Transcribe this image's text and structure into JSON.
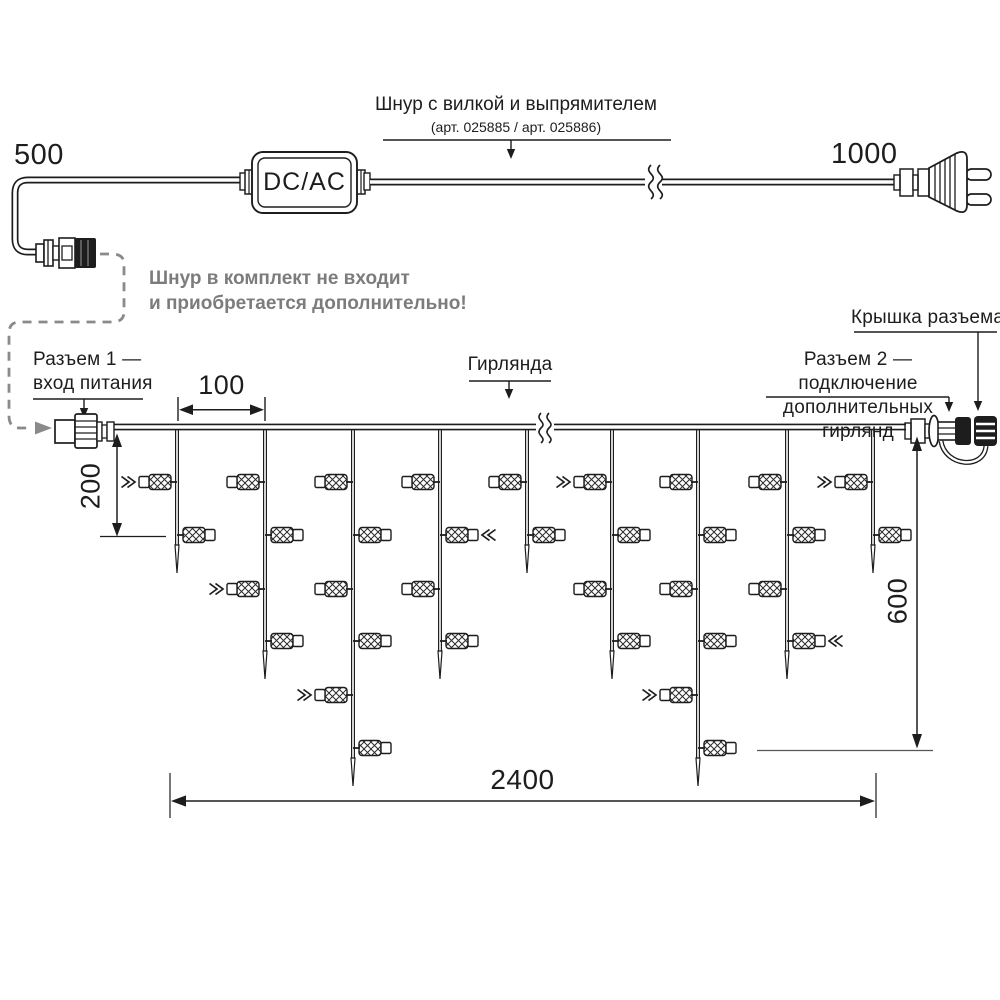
{
  "colors": {
    "line": "#1d1d1d",
    "note_gray": "#7c7c7c",
    "dash_gray": "#8a8a8a",
    "background": "#ffffff"
  },
  "power_cord": {
    "length_left_label": "500",
    "length_right_label": "1000",
    "converter_label": "DC/AC",
    "title": "Шнур с вилкой и выпрямителем",
    "subtitle": "(арт. 025885 / арт. 025886)",
    "note_line1": "Шнур в комплект не входит",
    "note_line2": "и приобретается дополнительно!"
  },
  "garland_labels": {
    "connector1_line1": "Разъем 1 —",
    "connector1_line2": "вход питания",
    "garland": "Гирлянда",
    "connector_cap": "Крышка разъема",
    "connector2_line1": "Разъем 2 — подключение",
    "connector2_line2": "дополнительных гирлянд"
  },
  "dimensions": {
    "drop_spacing": "100",
    "first_drop_depth": "200",
    "max_drop_depth": "600",
    "total_length": "2400"
  },
  "garland": {
    "wire_y": 427,
    "x_start": 114,
    "x_end": 906,
    "break_x": 545,
    "level_y": [
      482,
      535,
      589,
      641,
      695,
      748
    ],
    "drops": [
      {
        "x": 177,
        "bulbs": [
          {
            "level": 1,
            "side": "left",
            "arrow": true
          },
          {
            "level": 2,
            "side": "right",
            "arrow": false
          }
        ]
      },
      {
        "x": 265,
        "bulbs": [
          {
            "level": 1,
            "side": "left",
            "arrow": false
          },
          {
            "level": 2,
            "side": "right",
            "arrow": false
          },
          {
            "level": 3,
            "side": "left",
            "arrow": true
          },
          {
            "level": 4,
            "side": "right",
            "arrow": false
          }
        ]
      },
      {
        "x": 353,
        "bulbs": [
          {
            "level": 1,
            "side": "left",
            "arrow": false
          },
          {
            "level": 2,
            "side": "right",
            "arrow": false
          },
          {
            "level": 3,
            "side": "left",
            "arrow": false
          },
          {
            "level": 4,
            "side": "right",
            "arrow": false
          },
          {
            "level": 5,
            "side": "left",
            "arrow": true
          },
          {
            "level": 6,
            "side": "right",
            "arrow": false
          }
        ]
      },
      {
        "x": 440,
        "bulbs": [
          {
            "level": 1,
            "side": "left",
            "arrow": false
          },
          {
            "level": 2,
            "side": "right",
            "arrow": true
          },
          {
            "level": 3,
            "side": "left",
            "arrow": false
          },
          {
            "level": 4,
            "side": "right",
            "arrow": false
          }
        ]
      },
      {
        "x": 527,
        "bulbs": [
          {
            "level": 1,
            "side": "left",
            "arrow": false
          },
          {
            "level": 2,
            "side": "right",
            "arrow": false
          }
        ]
      },
      {
        "x": 612,
        "bulbs": [
          {
            "level": 1,
            "side": "left",
            "arrow": true
          },
          {
            "level": 2,
            "side": "right",
            "arrow": false
          },
          {
            "level": 3,
            "side": "left",
            "arrow": false
          },
          {
            "level": 4,
            "side": "right",
            "arrow": false
          }
        ]
      },
      {
        "x": 698,
        "bulbs": [
          {
            "level": 1,
            "side": "left",
            "arrow": false
          },
          {
            "level": 2,
            "side": "right",
            "arrow": false
          },
          {
            "level": 3,
            "side": "left",
            "arrow": false
          },
          {
            "level": 4,
            "side": "right",
            "arrow": false
          },
          {
            "level": 5,
            "side": "left",
            "arrow": true
          },
          {
            "level": 6,
            "side": "right",
            "arrow": false
          }
        ]
      },
      {
        "x": 787,
        "bulbs": [
          {
            "level": 1,
            "side": "left",
            "arrow": false
          },
          {
            "level": 2,
            "side": "right",
            "arrow": false
          },
          {
            "level": 3,
            "side": "left",
            "arrow": false
          },
          {
            "level": 4,
            "side": "right",
            "arrow": true
          }
        ]
      },
      {
        "x": 873,
        "bulbs": [
          {
            "level": 1,
            "side": "left",
            "arrow": true
          },
          {
            "level": 2,
            "side": "right",
            "arrow": false
          }
        ]
      }
    ]
  }
}
